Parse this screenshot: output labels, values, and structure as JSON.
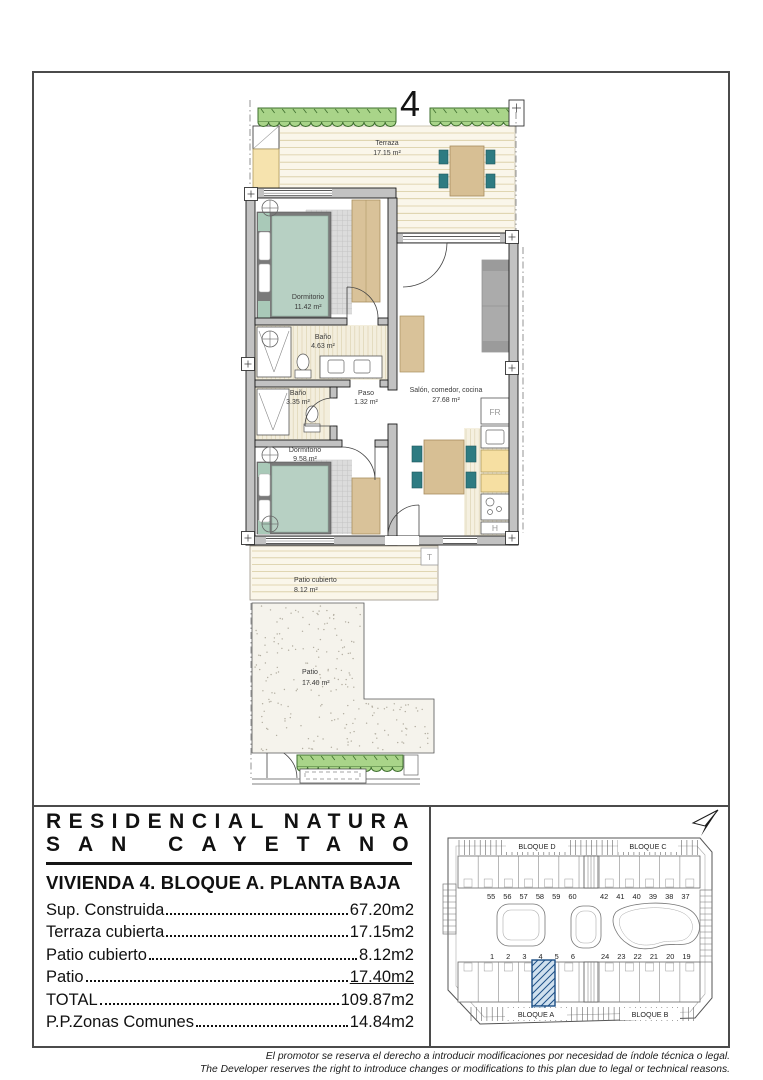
{
  "floor_plan": {
    "unit_number": "4",
    "rooms": [
      {
        "name": "Terraza",
        "area": "17.15 m²"
      },
      {
        "name": "Dormitorio",
        "area": "11.42 m²"
      },
      {
        "name": "Baño",
        "area": "4.63 m²"
      },
      {
        "name": "Baño",
        "area": "3.35 m²"
      },
      {
        "name": "Paso",
        "area": "1.32 m²"
      },
      {
        "name": "Salón, comedor, cocina",
        "area": "27.68 m²"
      },
      {
        "name": "Dormitorio",
        "area": "9.58 m²"
      },
      {
        "name": "Patio cubierto",
        "area": "8.12 m²"
      },
      {
        "name": "Patio",
        "area": "17.40 m²"
      }
    ],
    "appliance_labels": {
      "fridge": "FR",
      "hob": "H",
      "terrace_post": "T"
    }
  },
  "title_block": {
    "project_line1": "RESIDENCIAL NATURA",
    "project_line2": "SAN CAYETANO",
    "unit_title": "VIVIENDA 4. BLOQUE A. PLANTA BAJA",
    "specs": [
      {
        "label": "Sup. Construida",
        "value": "67.20m2"
      },
      {
        "label": "Terraza cubierta",
        "value": "17.15m2"
      },
      {
        "label": "Patio cubierto",
        "value": "8.12m2"
      },
      {
        "label": "Patio",
        "value": "17.40m2"
      },
      {
        "label": "TOTAL",
        "value": "109.87m2"
      },
      {
        "label": "P.P.Zonas Comunes",
        "value": "14.84m2"
      }
    ]
  },
  "site_plan": {
    "blocks": [
      {
        "label": "BLOQUE D"
      },
      {
        "label": "BLOQUE C"
      },
      {
        "label": "BLOQUE A"
      },
      {
        "label": "BLOQUE B"
      }
    ],
    "unit_rows": {
      "top_left": "55 56 57 58 59 60",
      "top_right": "42 41 40 39 38 37",
      "bottom_left": "1 2 3 4 5 6",
      "bottom_right": "24 23 22 21 20 19"
    },
    "highlighted_unit": "4",
    "highlight_color": "#1c4f86"
  },
  "disclaimer": {
    "line_es": "El promotor se reserva el derecho a introducir modificaciones por necesidad de índole técnica o legal.",
    "line_en": "The Developer reserves the right to introduce changes or modifications to this plan due to legal or technical reasons."
  },
  "colors": {
    "wall": "#c2c2c2",
    "hedge": "#a9d489",
    "deck": "#faf6ea",
    "bed": "#b7d0c3",
    "wood": "#d9c299",
    "cabinet": "#f6dfa2",
    "chair_teal": "#2e7b82",
    "highlight_blue": "#1c4f86",
    "frame": "#4b4b4b"
  }
}
